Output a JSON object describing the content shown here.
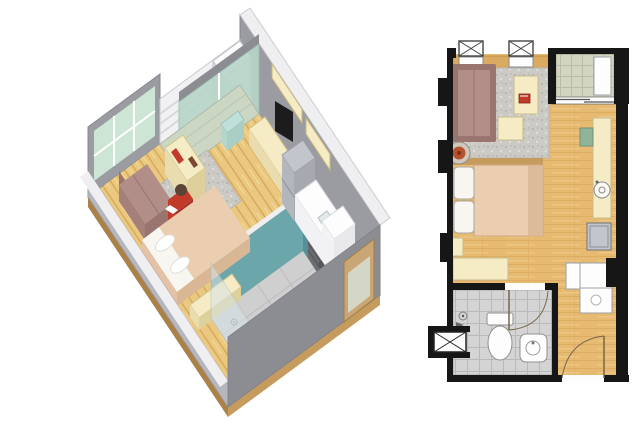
{
  "views": {
    "iso": {
      "label": "3d-isometric-cutaway-view",
      "rooms": [
        "balcony",
        "living-area",
        "sleeping-area",
        "kitchenette",
        "bathroom",
        "entry"
      ],
      "objects": [
        "air-conditioner",
        "louver-railing",
        "sliding-glass-door",
        "windows",
        "sofa",
        "area-rug",
        "desk",
        "person-seated",
        "tv-console",
        "tv",
        "wall-shelves",
        "refrigerator",
        "kitchen-counter",
        "sink",
        "tall-cabinet",
        "bed",
        "pillows",
        "bench",
        "teal-side-table",
        "bathroom-door",
        "vanity-mirror",
        "toilet",
        "floor-drain",
        "shower-glass",
        "entry-door"
      ]
    },
    "plan": {
      "label": "2d-floor-plan-view",
      "rooms": [
        "balcony",
        "living-area",
        "sleeping-area",
        "kitchen-strip",
        "bathroom",
        "entry"
      ],
      "fixtures": [
        "window-symbol",
        "window-symbol",
        "ac-unit",
        "sliding-door",
        "rug",
        "sofa",
        "desk",
        "laptop",
        "side-table",
        "stool",
        "bed",
        "pillows",
        "nightstand",
        "bench",
        "counter",
        "green-chair",
        "sink-circle",
        "appliance",
        "cabinets",
        "toilet",
        "wash-basin",
        "floor-drain",
        "shower-head",
        "bathroom-door-arc",
        "entry-door-arc",
        "ac-ledge-hatch"
      ]
    }
  },
  "palette": {
    "wall": "#9b9ba2",
    "wall_dark": "#8c8c93",
    "wall_light": "#b6b6bd",
    "wall_top": "#efeff1",
    "white_struct": "#f1f1f3",
    "glass": "#cde5d5",
    "glass_door": "#b7d6c8",
    "wood3d": "#eac87f",
    "wood3d_dark": "#d6a85c",
    "wood3d_light": "#f4da9b",
    "slab": "#c59c5e",
    "slab_dark": "#aa8146",
    "balc3d": "#ccd7c3",
    "rug": "#cbcac5",
    "rug_dot_dark": "#b2b1ad",
    "rug_dot_light": "#e3e2de",
    "teal": "#6aa6aa",
    "teal_dark": "#558f98",
    "bathfloor": "#cfcfcf",
    "mauve": "#b18e88",
    "mauve_dark": "#9a746f",
    "cream": "#f5ecc5",
    "cream_dark": "#ddd09a",
    "cream_side": "#e9ddb0",
    "peach": "#ebcdb0",
    "peach_dark": "#d9b795",
    "pillow": "#f8f6f1",
    "red": "#c23b2a",
    "red_dark": "#a93226",
    "head_brown": "#5a4436",
    "gray_appl": "#c3c5cc",
    "gray_appl_dark": "#a7a9b1",
    "gray_appl_side": "#b4b6bd",
    "white": "#fdfdfd",
    "white_dim": "#e9e9ec",
    "tv_black": "#1c1c1c",
    "door_wood": "#c9a674",
    "dark_door": "#6b6b70",
    "vanity_dark": "#3b3b40",
    "plan_wall": "#161616",
    "wood_plan": "#e7ba72",
    "wood_plan_dark": "#d3a055",
    "wood_plan_light": "#f1cf92",
    "balc_plan": "#d2d6c1",
    "bath_plan": "#d4d4d4",
    "green_item": "#8fb49a",
    "stool_red": "#b5532e",
    "stool_rim": "#cfc8bd",
    "tan_wall": "#d9aa60",
    "arc_brown": "#77674a"
  }
}
